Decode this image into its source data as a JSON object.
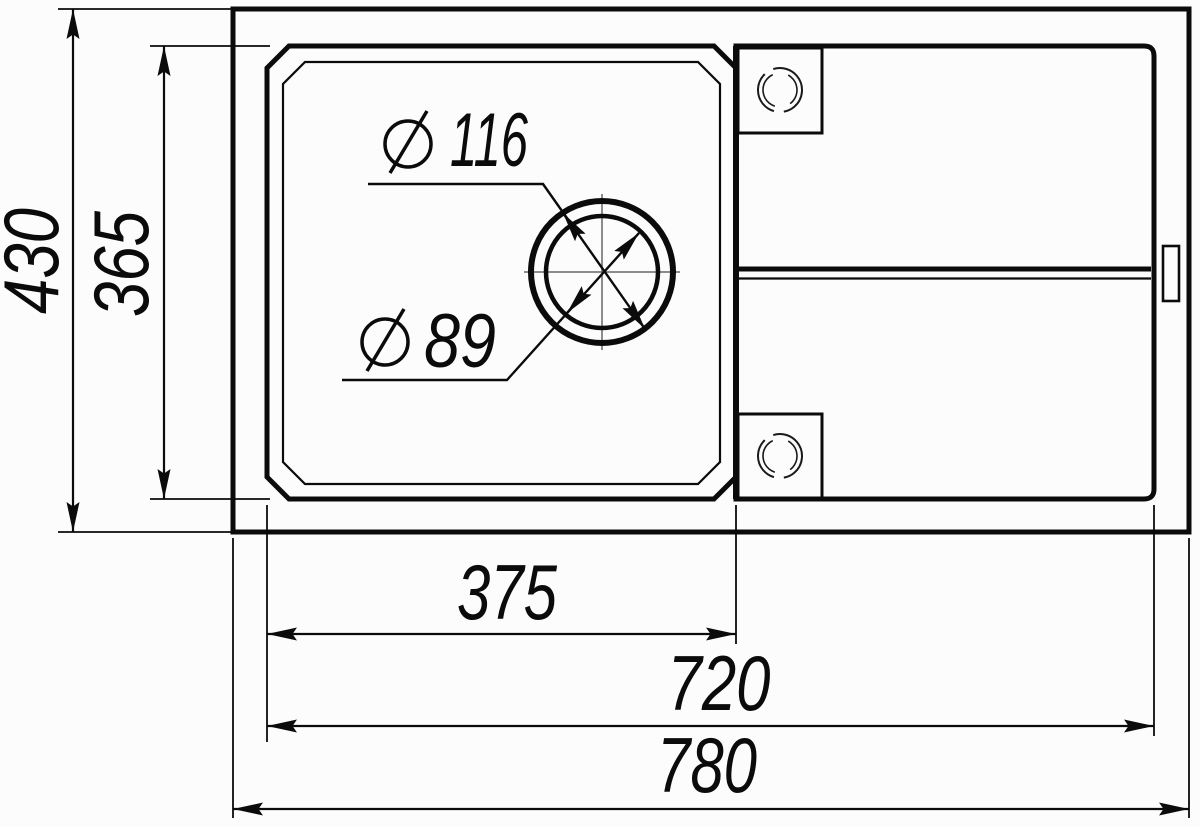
{
  "drawing": {
    "colors": {
      "line": "#0b0b0b",
      "background": "#fcfcfc",
      "centerline": "#666666"
    },
    "dimensions": {
      "overall_height": {
        "label": "430"
      },
      "basin_height": {
        "label": "365"
      },
      "bowl_width": {
        "label": "375"
      },
      "basin_width": {
        "label": "720"
      },
      "overall_width": {
        "label": "780"
      },
      "drain_outer_diameter": {
        "symbol": "⌀",
        "value": "116",
        "label": "⌀ 116"
      },
      "drain_inner_diameter": {
        "symbol": "⌀",
        "value": "89",
        "label": "⌀ 89"
      }
    }
  }
}
